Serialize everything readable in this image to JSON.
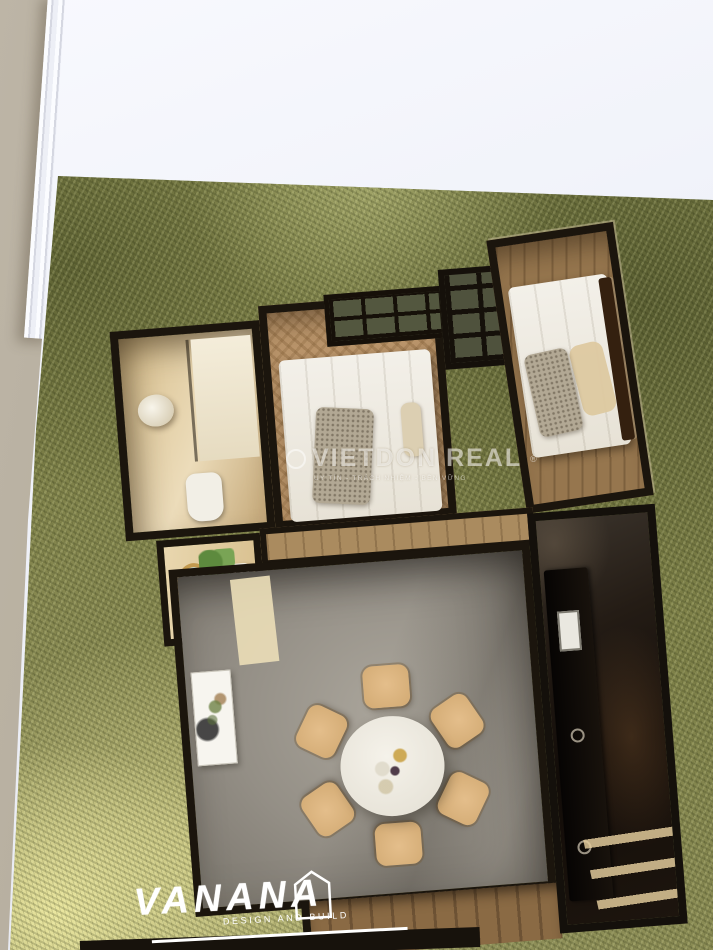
{
  "watermark": {
    "brand": "VIETDON REAL",
    "reg_mark": "®",
    "tagline": "UY TÍN - TRÁCH NHIỆM - BỀN VỮNG"
  },
  "brand": {
    "name": "VANANA",
    "tagline": "DESIGN AND BUILD"
  },
  "colors": {
    "desk_surface": "#b5ac9c",
    "paper_white": "#f1f2f8",
    "grass_dark_olive": "#7b7e49",
    "grass_light_yellow": "#cfcb8e",
    "plan_wall_black": "#1b150d",
    "bedroom_wood_floor": "#b9946a",
    "living_concrete_floor": "#9b968c",
    "kitchen_shadow": "#16100b",
    "bedding_white": "#f0ede4",
    "chair_wood": "#dcb687"
  }
}
